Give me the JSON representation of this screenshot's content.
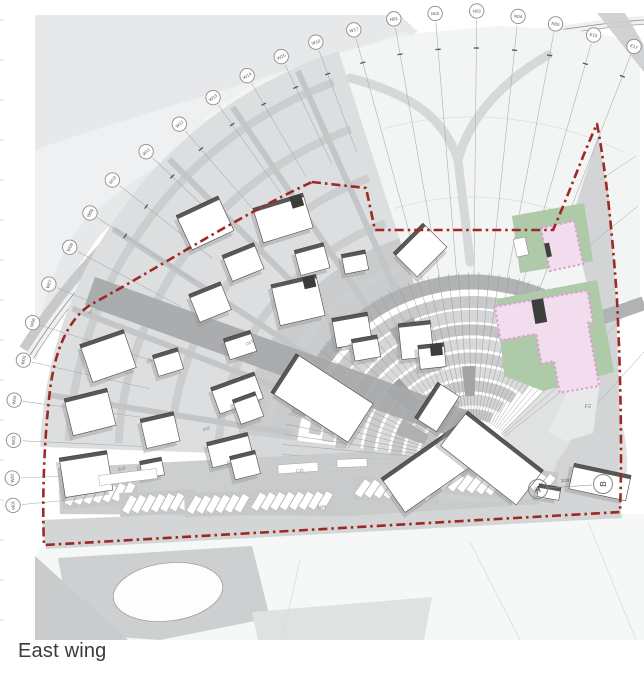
{
  "caption": "East wing",
  "map": {
    "bubbles": [
      {
        "label": "W01"
      },
      {
        "label": "W02"
      },
      {
        "label": "W03"
      },
      {
        "label": "W04"
      },
      {
        "label": "W05"
      },
      {
        "label": "W06"
      },
      {
        "label": "W07"
      },
      {
        "label": "W08"
      },
      {
        "label": "W09"
      },
      {
        "label": "W10"
      },
      {
        "label": "W11"
      },
      {
        "label": "W12"
      },
      {
        "label": "W13"
      },
      {
        "label": "W14"
      },
      {
        "label": "W15"
      },
      {
        "label": "W16"
      },
      {
        "label": "W17"
      },
      {
        "label": "N01"
      },
      {
        "label": "N02"
      },
      {
        "label": "N03"
      },
      {
        "label": "N04"
      },
      {
        "label": "N05"
      },
      {
        "label": "E15"
      },
      {
        "label": "E17"
      }
    ],
    "section_markers": [
      {
        "label": "A"
      },
      {
        "label": "B"
      }
    ],
    "lot_labels": [
      {
        "label": "B4"
      },
      {
        "label": "D8"
      },
      {
        "label": "D13"
      },
      {
        "label": "D11"
      },
      {
        "label": "B18"
      },
      {
        "label": "C15"
      },
      {
        "label": "D19"
      }
    ],
    "zone_label": "F2",
    "dimension_label": "2000"
  },
  "colors": {
    "boundary_red": "#9e2823",
    "building_pink": "#f2dcee",
    "pink_border": "#dc9fd2",
    "green_area": "#aecaa8",
    "terrain_gray": "#e6e8e9",
    "road_gray": "#b2b4b6",
    "access_road_gray": "#a7a9ab"
  }
}
